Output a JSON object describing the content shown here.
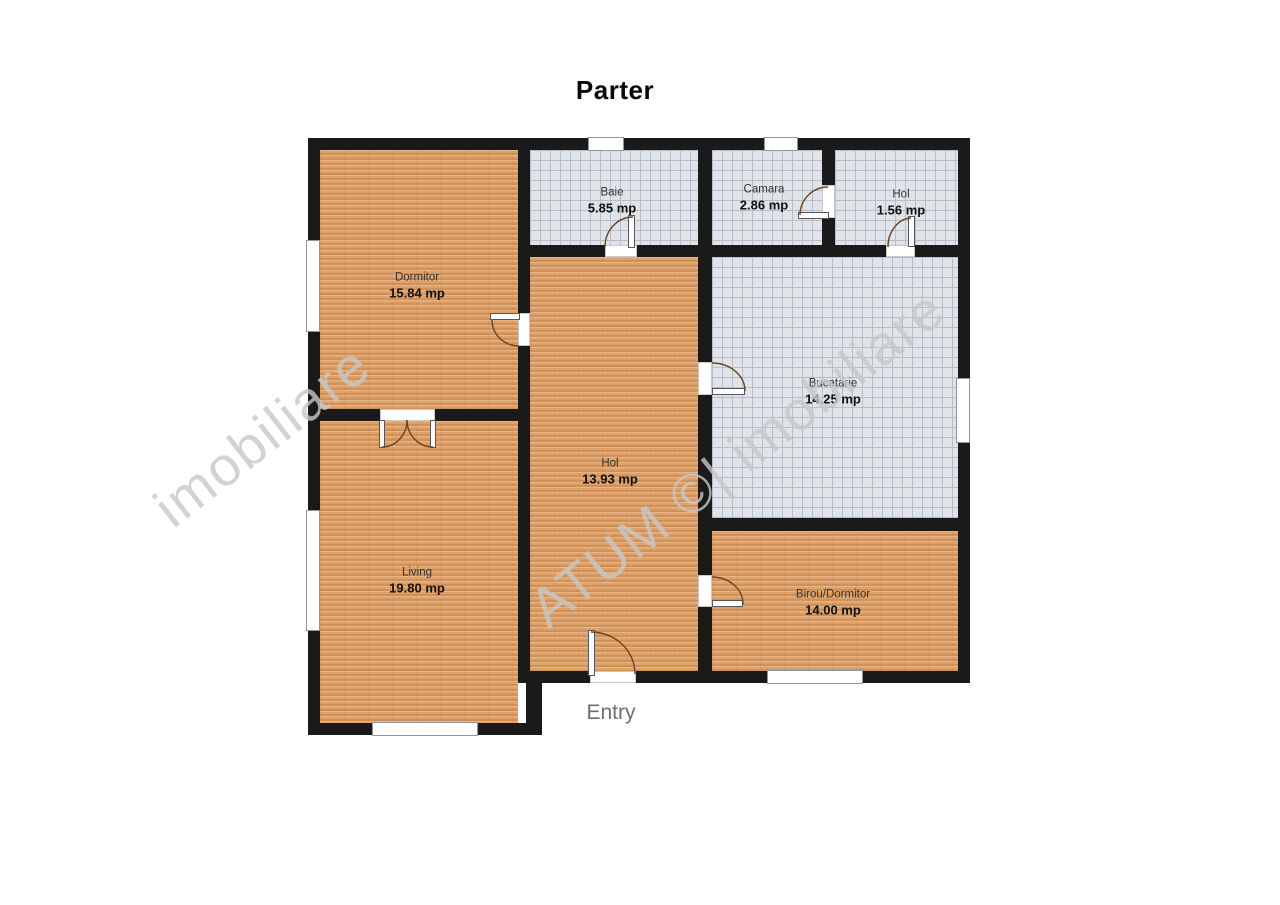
{
  "title": "Parter",
  "entry_label": "Entry",
  "watermarks": [
    {
      "text": "ATUM ©| imobiliare"
    },
    {
      "text": "imobiliare"
    }
  ],
  "colors": {
    "wall": "#1a1a1a",
    "wood": "#dfa167",
    "tile": "#e0e4e8",
    "tile_line": "#b4bfc9",
    "door_arc": "#6b4423",
    "entry_text": "#6e6e6e",
    "watermark": "#c8c8c8"
  },
  "plan": {
    "rooms": [
      {
        "id": "dormitor",
        "name": "Dormitor",
        "area": "15.84 mp",
        "floor": "wood",
        "x": 320,
        "y": 150,
        "w": 198,
        "h": 259,
        "lx": 417,
        "ly": 286
      },
      {
        "id": "baie",
        "name": "Baie",
        "area": "5.85 mp",
        "floor": "tile",
        "x": 530,
        "y": 150,
        "w": 168,
        "h": 95,
        "lx": 612,
        "ly": 201
      },
      {
        "id": "camara",
        "name": "Camara",
        "area": "2.86 mp",
        "floor": "tile",
        "x": 712,
        "y": 150,
        "w": 110,
        "h": 95,
        "lx": 764,
        "ly": 198
      },
      {
        "id": "hol-mic",
        "name": "Hol",
        "area": "1.56 mp",
        "floor": "tile",
        "x": 835,
        "y": 150,
        "w": 123,
        "h": 95,
        "lx": 901,
        "ly": 203
      },
      {
        "id": "hol",
        "name": "Hol",
        "area": "13.93 mp",
        "floor": "wood",
        "x": 530,
        "y": 257,
        "w": 168,
        "h": 414,
        "lx": 610,
        "ly": 472
      },
      {
        "id": "bucatarie",
        "name": "Bucatarie",
        "area": "14.25 mp",
        "floor": "tile",
        "x": 712,
        "y": 257,
        "w": 246,
        "h": 261,
        "lx": 833,
        "ly": 392
      },
      {
        "id": "living",
        "name": "Living",
        "area": "19.80 mp",
        "floor": "wood",
        "x": 320,
        "y": 421,
        "w": 198,
        "h": 302,
        "lx": 417,
        "ly": 581
      },
      {
        "id": "birou",
        "name": "Birou/Dormitor",
        "area": "14.00 mp",
        "floor": "wood",
        "x": 712,
        "y": 531,
        "w": 246,
        "h": 140,
        "lx": 833,
        "ly": 603
      }
    ],
    "walls": [
      {
        "id": "outer-top",
        "x": 308,
        "y": 138,
        "w": 662,
        "h": 12
      },
      {
        "id": "outer-left",
        "x": 308,
        "y": 138,
        "w": 12,
        "h": 597
      },
      {
        "id": "outer-right",
        "x": 958,
        "y": 138,
        "w": 12,
        "h": 545
      },
      {
        "id": "vert-main",
        "x": 518,
        "y": 138,
        "w": 12,
        "h": 545
      },
      {
        "id": "vert-baie-camara",
        "x": 698,
        "y": 138,
        "w": 14,
        "h": 119
      },
      {
        "id": "vert-camara-hol",
        "x": 822,
        "y": 138,
        "w": 13,
        "h": 119
      },
      {
        "id": "horiz-top-rooms",
        "x": 518,
        "y": 245,
        "w": 452,
        "h": 12
      },
      {
        "id": "vert-hol-bucatarie",
        "x": 698,
        "y": 245,
        "w": 14,
        "h": 438
      },
      {
        "id": "horiz-dormitor-living",
        "x": 308,
        "y": 409,
        "w": 222,
        "h": 12
      },
      {
        "id": "horiz-bucatarie-birou",
        "x": 698,
        "y": 518,
        "w": 272,
        "h": 13
      },
      {
        "id": "horiz-hol-bottom",
        "x": 518,
        "y": 671,
        "w": 452,
        "h": 12
      },
      {
        "id": "horiz-living-bottom",
        "x": 308,
        "y": 723,
        "w": 234,
        "h": 12
      },
      {
        "id": "vert-step",
        "x": 526,
        "y": 671,
        "w": 16,
        "h": 64
      }
    ],
    "windows": [
      {
        "id": "window-top-baie",
        "x": 588,
        "y": 137,
        "w": 36,
        "h": 14
      },
      {
        "id": "window-top-camara",
        "x": 764,
        "y": 137,
        "w": 34,
        "h": 14
      },
      {
        "id": "window-left-dormitor",
        "x": 306,
        "y": 240,
        "w": 14,
        "h": 92
      },
      {
        "id": "window-left-living",
        "x": 306,
        "y": 510,
        "w": 14,
        "h": 121
      },
      {
        "id": "window-bottom-living",
        "x": 372,
        "y": 722,
        "w": 106,
        "h": 14
      },
      {
        "id": "window-bottom-birou",
        "x": 767,
        "y": 670,
        "w": 96,
        "h": 14
      },
      {
        "id": "window-right-bucatarie",
        "x": 956,
        "y": 378,
        "w": 14,
        "h": 65
      }
    ],
    "doors": [
      {
        "id": "door-baie",
        "gap": {
          "x": 605,
          "y": 245,
          "w": 32,
          "h": 12
        },
        "leaf": {
          "x": 628,
          "y": 215,
          "w": 7,
          "h": 33
        },
        "arc": "M 605 247 A 28 30 0 0 1 633 217"
      },
      {
        "id": "door-camara",
        "gap": {
          "x": 822,
          "y": 185,
          "w": 13,
          "h": 33
        },
        "leaf": {
          "x": 798,
          "y": 212,
          "w": 31,
          "h": 7
        },
        "arc": "M 828 187 A 28 28 0 0 0 800 215"
      },
      {
        "id": "door-hol-mic",
        "gap": {
          "x": 886,
          "y": 245,
          "w": 29,
          "h": 12
        },
        "leaf": {
          "x": 908,
          "y": 216,
          "w": 7,
          "h": 31
        },
        "arc": "M 888 247 A 24 29 0 0 1 911 218"
      },
      {
        "id": "door-dormitor",
        "gap": {
          "x": 518,
          "y": 313,
          "w": 12,
          "h": 33
        },
        "leaf": {
          "x": 490,
          "y": 313,
          "w": 30,
          "h": 7
        },
        "arc": "M 492 320 A 27 26 0 0 0 519 346"
      },
      {
        "id": "door-bucatarie",
        "gap": {
          "x": 698,
          "y": 362,
          "w": 14,
          "h": 33
        },
        "leaf": {
          "x": 712,
          "y": 388,
          "w": 33,
          "h": 7
        },
        "arc": "M 712 363 A 33 28 0 0 1 745 391"
      },
      {
        "id": "door-birou",
        "gap": {
          "x": 698,
          "y": 575,
          "w": 14,
          "h": 32
        },
        "leaf": {
          "x": 712,
          "y": 600,
          "w": 31,
          "h": 7
        },
        "arc": "M 712 577 A 31 27 0 0 1 743 604"
      },
      {
        "id": "door-entry",
        "gap": {
          "x": 590,
          "y": 671,
          "w": 46,
          "h": 12
        },
        "leaf": {
          "x": 588,
          "y": 630,
          "w": 7,
          "h": 46
        },
        "arc": "M 591 632 A 44 42 0 0 1 635 674"
      },
      {
        "id": "door-french-left",
        "gap": {
          "x": 380,
          "y": 409,
          "w": 55,
          "h": 12
        },
        "leaf": {
          "x": 379,
          "y": 420,
          "w": 6,
          "h": 28
        },
        "arc": "M 382 447 A 25 27 0 0 0 407 420"
      },
      {
        "id": "door-french-right",
        "gap": null,
        "leaf": {
          "x": 430,
          "y": 420,
          "w": 6,
          "h": 28
        },
        "arc": "M 433 447 A 26 27 0 0 1 407 420"
      }
    ]
  }
}
